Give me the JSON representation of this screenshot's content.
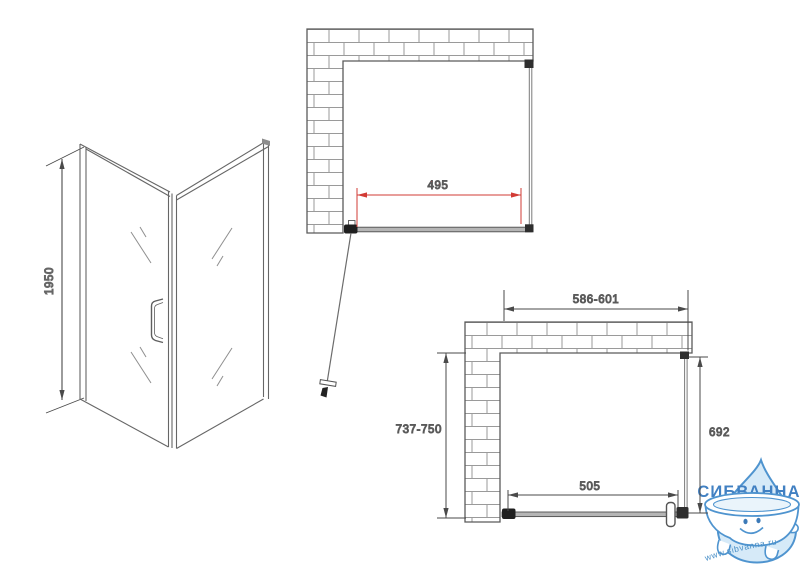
{
  "side_view": {
    "height_label": "1950"
  },
  "plan_top": {
    "width_label": "495"
  },
  "plan_bottom": {
    "overall_width_label": "586-601",
    "overall_depth_label": "737-750",
    "glass_depth_label": "692",
    "door_width_label": "505"
  },
  "watermark": {
    "brand": "СИБВАННА",
    "website": "www.sibvanna.ru"
  },
  "colors": {
    "drawing_line": "#5a5a5a",
    "dimension_red": "#d23b35",
    "brick_joint": "#9a9a9a",
    "logo_blue": "#4180c2",
    "drop_fill": "#d6eaf8",
    "drop_stroke": "#4f94cf"
  }
}
